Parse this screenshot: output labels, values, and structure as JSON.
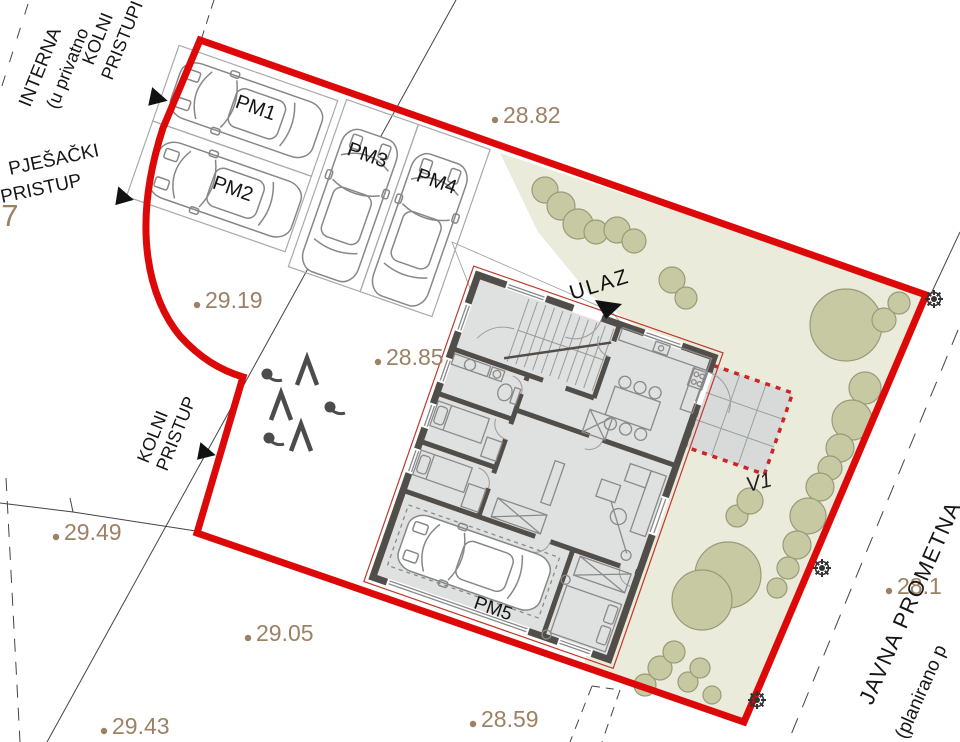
{
  "plan": {
    "labels": {
      "interna": "INTERNA",
      "interna_sub": "(u privatno",
      "kolni_pristupi": [
        "KOLNI",
        "PRISTUPI"
      ],
      "pjesacki_pristup": [
        "PJEŠAČKI",
        "PRISTUP"
      ],
      "kolni_pristup": [
        "KOLNI",
        "PRISTUP"
      ],
      "ulaz": "ULAZ",
      "javna_prometna": "JAVNA PROMETNA",
      "javna_prometna_sub": "(planirano p",
      "v1": "V1",
      "parcel_number": "77"
    },
    "parking_labels": [
      "PM1",
      "PM2",
      "PM3",
      "PM4",
      "PM5"
    ],
    "elevations": [
      {
        "value": "28.82",
        "x": 503,
        "y": 123
      },
      {
        "value": "29.19",
        "x": 205,
        "y": 308
      },
      {
        "value": "28.85",
        "x": 386,
        "y": 365
      },
      {
        "value": "29.49",
        "x": 64,
        "y": 540
      },
      {
        "value": "29.05",
        "x": 256,
        "y": 641
      },
      {
        "value": "29.43",
        "x": 112,
        "y": 734
      },
      {
        "value": "28.59",
        "x": 481,
        "y": 727
      },
      {
        "value": "28.1",
        "x": 897,
        "y": 594
      }
    ],
    "colors": {
      "boundary_red": "#dd0808",
      "terrace_dash_red": "#cc2525",
      "building_outline_red": "#c0392b",
      "elevation_tan": "#9c8164",
      "green_area": "#eaebdb",
      "tree_fill": "#c6c9a2",
      "tree_stroke": "#989c77",
      "room_fill": "#dfe0e0",
      "wall_dark": "#514e4a"
    },
    "vegetation": {
      "trees": [
        [
          545,
          190,
          13
        ],
        [
          561,
          206,
          14
        ],
        [
          578,
          224,
          15
        ],
        [
          596,
          232,
          12
        ],
        [
          617,
          230,
          13
        ],
        [
          634,
          241,
          12
        ],
        [
          672,
          280,
          13
        ],
        [
          686,
          298,
          11
        ],
        [
          846,
          325,
          36
        ],
        [
          884,
          320,
          12
        ],
        [
          899,
          303,
          11
        ],
        [
          865,
          388,
          16
        ],
        [
          852,
          420,
          20
        ],
        [
          840,
          448,
          14
        ],
        [
          830,
          468,
          12
        ],
        [
          820,
          487,
          14
        ],
        [
          808,
          516,
          18
        ],
        [
          797,
          545,
          14
        ],
        [
          788,
          568,
          11
        ],
        [
          777,
          588,
          10
        ],
        [
          737,
          516,
          11
        ],
        [
          750,
          501,
          13
        ],
        [
          728,
          575,
          33
        ],
        [
          702,
          600,
          30
        ],
        [
          645,
          685,
          11
        ],
        [
          660,
          668,
          12
        ],
        [
          674,
          652,
          11
        ],
        [
          688,
          682,
          10
        ],
        [
          700,
          668,
          10
        ],
        [
          712,
          695,
          9
        ]
      ],
      "conifers": [
        [
          307,
          372
        ],
        [
          281,
          407
        ],
        [
          301,
          438
        ]
      ],
      "bushes": [
        [
          267,
          374
        ],
        [
          330,
          407
        ],
        [
          269,
          438
        ]
      ]
    },
    "utility_poles": [
      [
        934,
        299
      ],
      [
        822,
        568
      ],
      [
        757,
        700
      ]
    ]
  }
}
